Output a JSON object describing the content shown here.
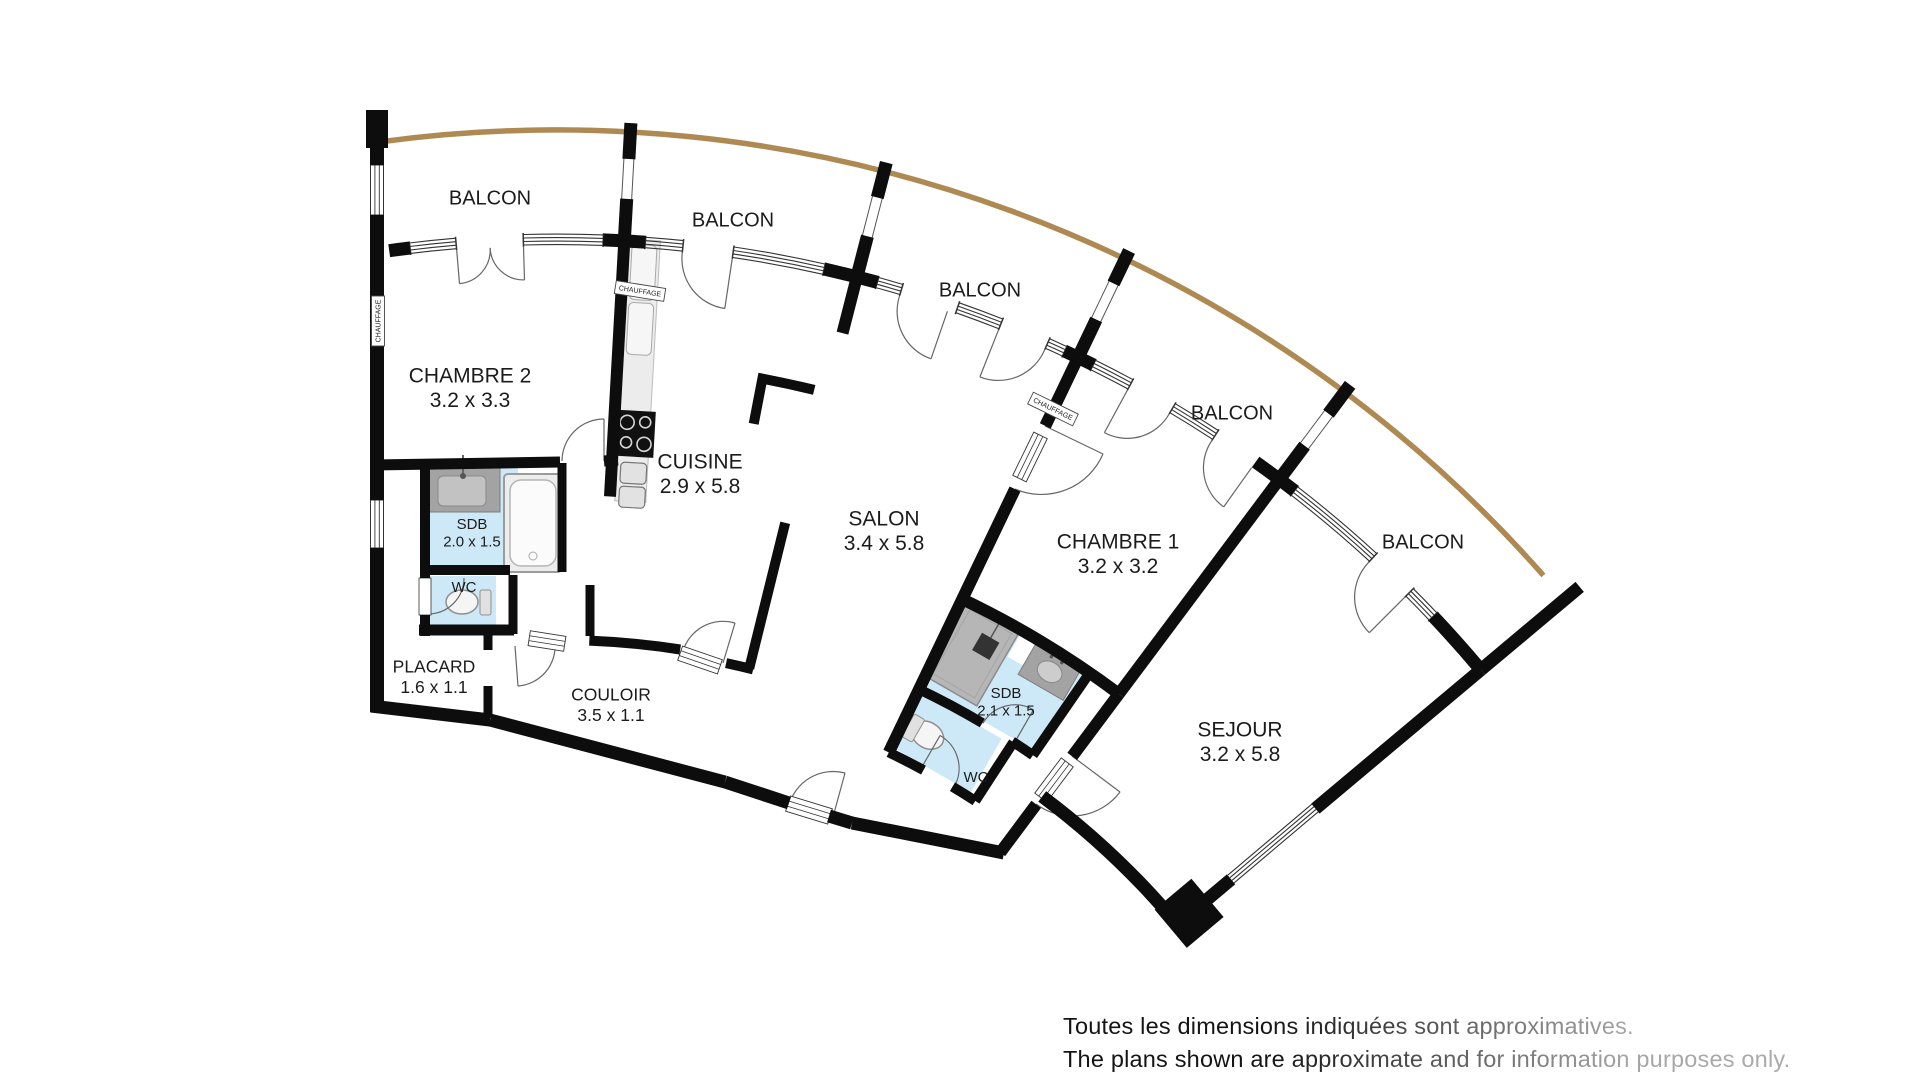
{
  "colors": {
    "wall": "#0d0d0d",
    "railing": "#ae8a52",
    "water": "#cde9f7",
    "counter_gray": "#a3a3a3",
    "kitchen_strip": "#ececec",
    "thin_line": "#555555"
  },
  "balcony_labels": [
    {
      "text": "BALCON",
      "x": 490,
      "y": 199
    },
    {
      "text": "BALCON",
      "x": 733,
      "y": 221
    },
    {
      "text": "BALCON",
      "x": 980,
      "y": 291
    },
    {
      "text": "BALCON",
      "x": 1232,
      "y": 414
    },
    {
      "text": "BALCON",
      "x": 1423,
      "y": 543
    }
  ],
  "rooms": [
    {
      "id": "chambre-2",
      "name": "CHAMBRE 2",
      "dims": "3.2 x 3.3",
      "x": 470,
      "y": 377,
      "size": 21
    },
    {
      "id": "cuisine",
      "name": "CUISINE",
      "dims": "2.9 x 5.8",
      "x": 700,
      "y": 463,
      "size": 21
    },
    {
      "id": "salon",
      "name": "SALON",
      "dims": "3.4 x 5.8",
      "x": 884,
      "y": 520,
      "size": 21
    },
    {
      "id": "chambre-1",
      "name": "CHAMBRE 1",
      "dims": "3.2 x 3.2",
      "x": 1118,
      "y": 543,
      "size": 21
    },
    {
      "id": "sejour",
      "name": "SEJOUR",
      "dims": "3.2 x 5.8",
      "x": 1240,
      "y": 731,
      "size": 21
    },
    {
      "id": "sdb-1",
      "name": "SDB",
      "dims": "2.0 x 1.5",
      "x": 472,
      "y": 525,
      "size": 15
    },
    {
      "id": "wc-1",
      "name": "WC",
      "dims": "",
      "x": 464,
      "y": 588,
      "size": 15
    },
    {
      "id": "placard",
      "name": "PLACARD",
      "dims": "1.6 x 1.1",
      "x": 434,
      "y": 668,
      "size": 17.5
    },
    {
      "id": "couloir",
      "name": "COULOIR",
      "dims": "3.5 x 1.1",
      "x": 611,
      "y": 696,
      "size": 17.5
    },
    {
      "id": "sdb-2",
      "name": "SDB",
      "dims": "2.1 x 1.5",
      "x": 1006,
      "y": 694,
      "size": 15
    },
    {
      "id": "wc-2",
      "name": "WC",
      "dims": "",
      "x": 976,
      "y": 778,
      "size": 15
    }
  ],
  "heating_labels": [
    {
      "text": "CHAUFFAGE",
      "x": 378,
      "y": 321,
      "rot": -90
    },
    {
      "text": "CHAUFFAGE",
      "x": 640,
      "y": 291,
      "rot": 9
    },
    {
      "text": "CHAUFFAGE",
      "x": 1053,
      "y": 409,
      "rot": 26
    }
  ],
  "disclaimer": {
    "line1": "Toutes les dimensions indiquées sont approximatives.",
    "line2": "The plans shown are approximate and for information purposes only."
  }
}
